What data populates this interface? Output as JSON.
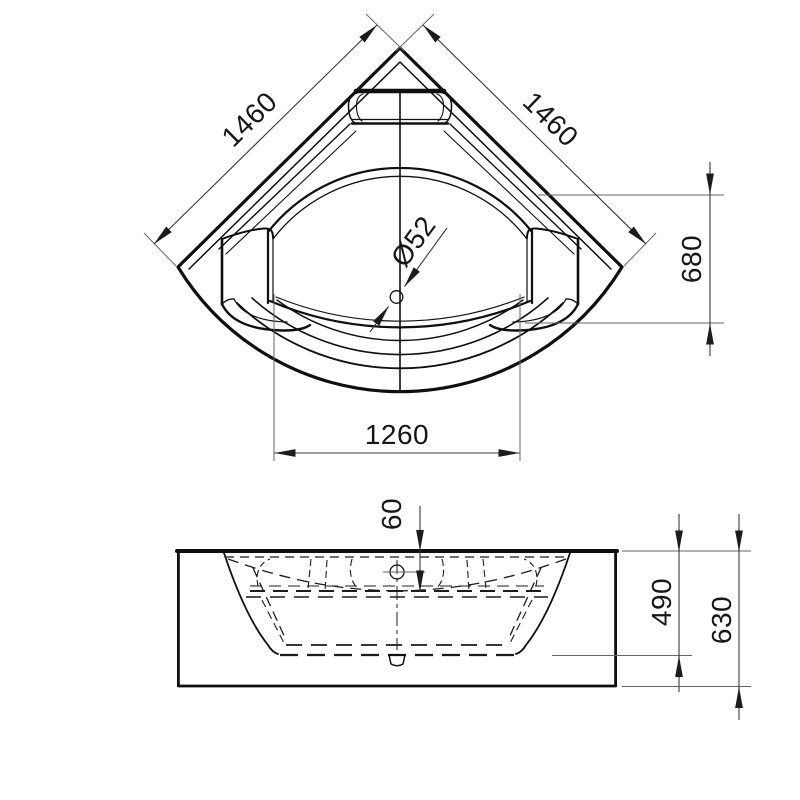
{
  "drawing": {
    "kind": "bathtub-dimension-drawing",
    "colors": {
      "line": "#0f0f0f",
      "dimension_line": "#3a3a3a",
      "extension_line": "#666666",
      "background": "#ffffff"
    },
    "top_view": {
      "dim_left_side": "1460",
      "dim_right_side": "1460",
      "dim_drain_diameter": "Ø52",
      "dim_vertical_offset": "680",
      "dim_inner_width": "1260"
    },
    "front_view": {
      "dim_rim_depth": "60",
      "dim_basin_depth": "490",
      "dim_total_height": "630"
    }
  }
}
